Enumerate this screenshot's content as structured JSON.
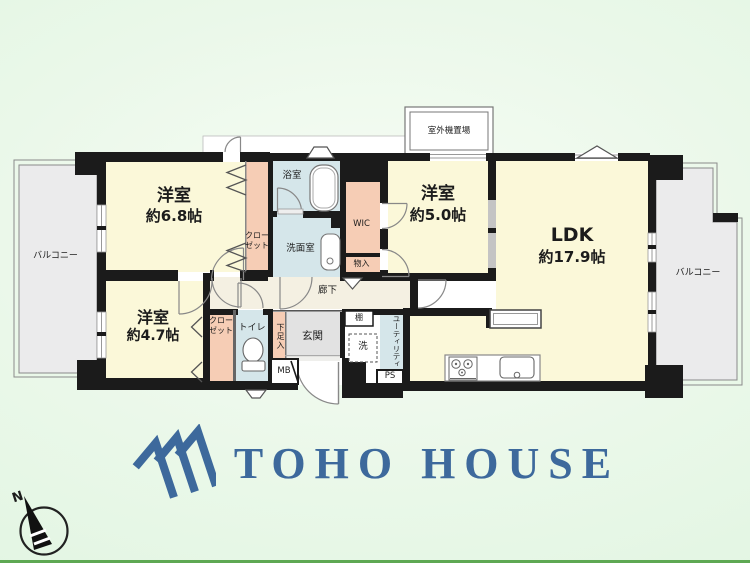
{
  "floorplan": {
    "rooms": {
      "bedroom1": {
        "name": "洋室",
        "size": "約6.8帖"
      },
      "bedroom2": {
        "name": "洋室",
        "size": "約5.0帖"
      },
      "bedroom3": {
        "name": "洋室",
        "size": "約4.7帖"
      },
      "ldk": {
        "name": "LDK",
        "size": "約17.9帖"
      },
      "bathroom": "浴室",
      "washroom": "洗面室",
      "wic": "WIC",
      "storage": "物入",
      "closet_upper": {
        "line1": "クロー",
        "line2": "ゼット"
      },
      "closet_lower": {
        "line1": "クロー",
        "line2": "ゼット"
      },
      "toilet": "トイレ",
      "hallway": "廊下",
      "entrance": "玄関",
      "shoe_cabinet": "下足入",
      "shelf": "棚",
      "washer": "洗",
      "utility": "ユーティリティ",
      "meter_box": "MB",
      "pipe_space": "PS",
      "outdoor_unit": "室外機置場",
      "balcony_left": "バルコニー",
      "balcony_right": "バルコニー"
    },
    "compass": {
      "north_label": "N"
    }
  },
  "logo": {
    "text": "TOHO HOUSE"
  },
  "colors": {
    "room_cream": "#fbf8d9",
    "wet_area_blue": "#d5e6ea",
    "closet_pink": "#f6cdb5",
    "hall_beige": "#f4f0e2",
    "entrance_gray": "#e2e2e2",
    "balcony_gray": "#ebebec",
    "wall_black": "#1b1b1b",
    "logo_blue": "#3d699c",
    "background_green": "#ddf4de",
    "bottom_line_green": "#5ea853"
  }
}
